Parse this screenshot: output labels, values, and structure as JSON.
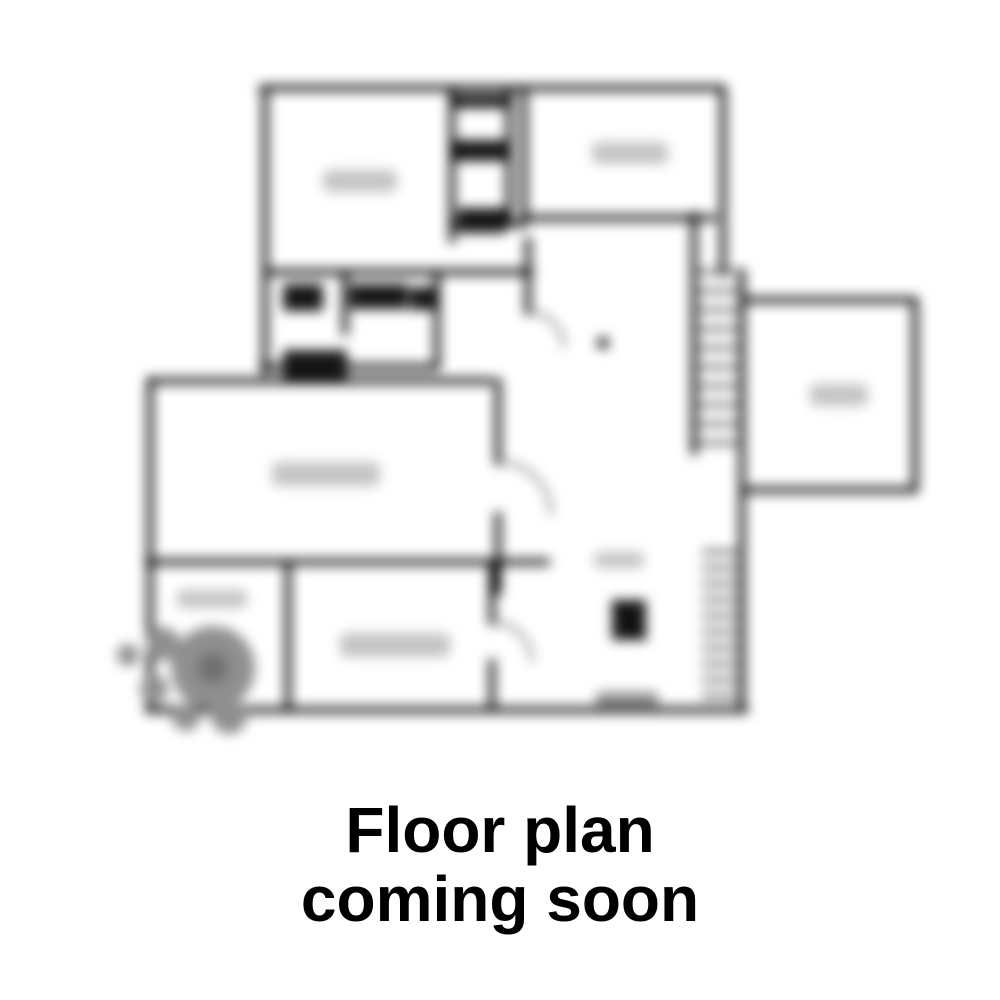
{
  "caption": {
    "line1": "Floor plan",
    "line2": "coming soon",
    "color": "#000000"
  },
  "floorplan": {
    "kind": "blurred-floor-plan-preview",
    "blur_px": 6,
    "colors": {
      "wall": "#000000",
      "fixture": "#161616",
      "smudge": "#c4c4c4",
      "shrub": "#8f8f8f",
      "shrub_dark": "#707070",
      "threshold": "#8d8d8d"
    }
  }
}
